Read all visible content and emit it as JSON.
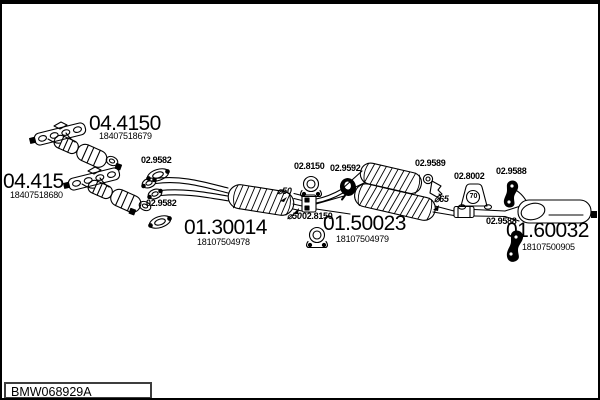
{
  "colors": {
    "background": "#ffffff",
    "line": "#000000"
  },
  "title_block": {
    "drawing_code": "BMW068929A"
  },
  "diagram": {
    "main_parts": [
      {
        "code": "04.4150",
        "oem": "18407518679"
      },
      {
        "code": "04.415",
        "oem": "18407518680"
      },
      {
        "code": "01.30014",
        "oem": "18107504978"
      },
      {
        "code": "01.50023",
        "oem": "18107504979"
      },
      {
        "code": "01.60032",
        "oem": "18107500905"
      }
    ],
    "small_parts": [
      {
        "code": "02.9582"
      },
      {
        "code": "02.9582"
      },
      {
        "code": "02.8150"
      },
      {
        "code": "02.8150"
      },
      {
        "code": "02.9592"
      },
      {
        "code": "02.9589"
      },
      {
        "code": "02.8002",
        "marking": "70"
      },
      {
        "code": "02.9588"
      },
      {
        "code": "02.9588"
      }
    ],
    "pipe_diameters": [
      "⌀50",
      "⌀50",
      "⌀65"
    ]
  }
}
